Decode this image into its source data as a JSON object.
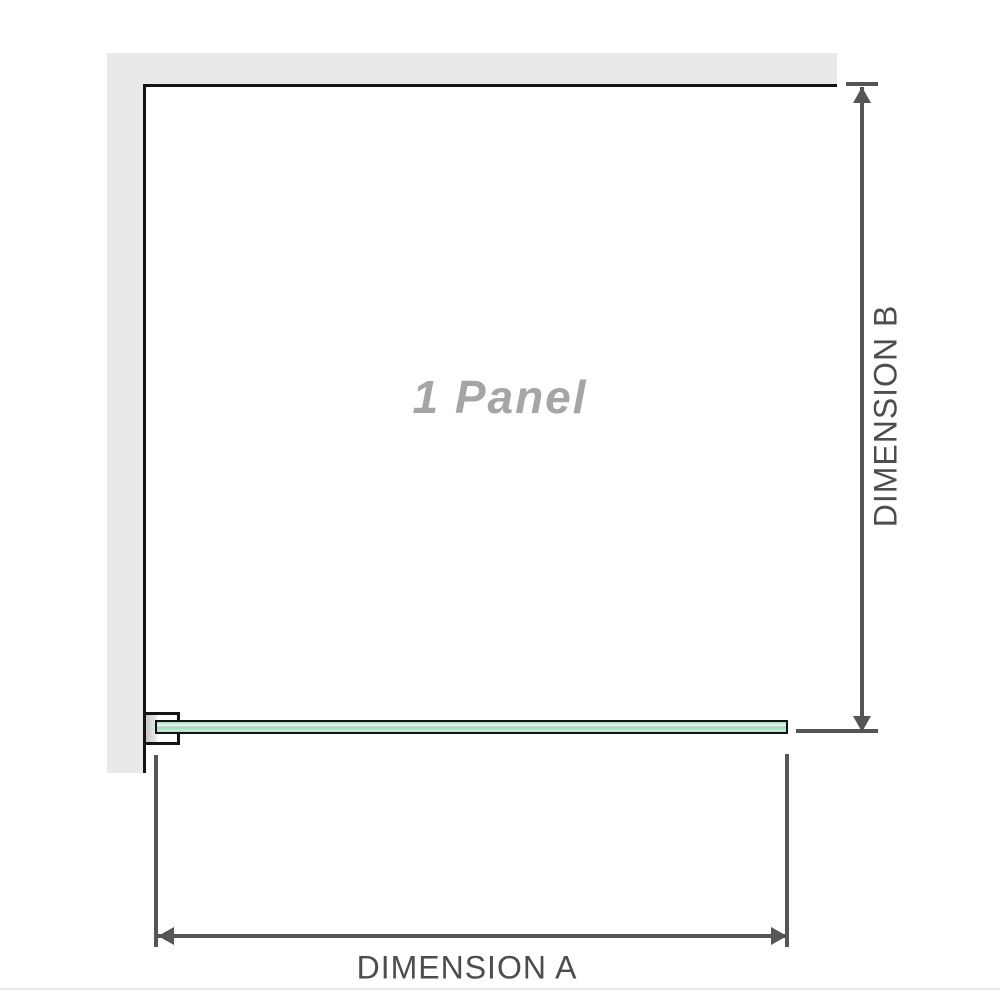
{
  "diagram": {
    "panel_label": "1 Panel",
    "dimension_a_label": "DIMENSION A",
    "dimension_b_label": "DIMENSION B"
  },
  "colors": {
    "wall": "#e9e9e9",
    "outline": "#141414",
    "dimension": "#555555",
    "label_text": "#4d4d4d",
    "panel_label_text": "#a5a5a5",
    "glass_green": "#9ed9b8",
    "background": "#ffffff"
  }
}
